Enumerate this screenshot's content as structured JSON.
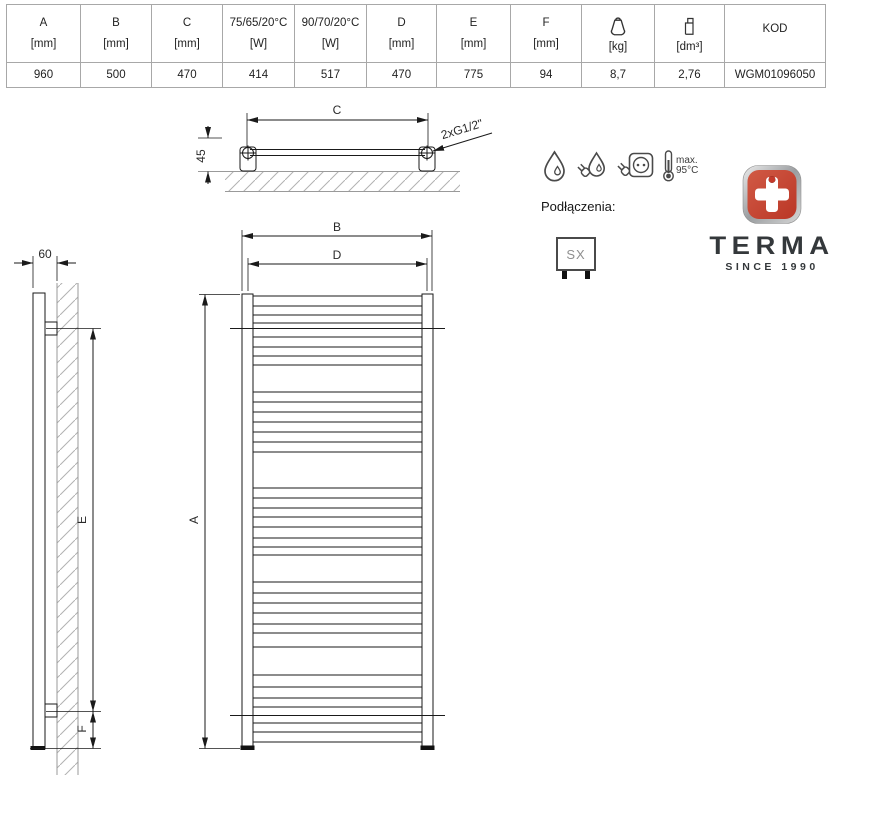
{
  "table": {
    "columns": [
      {
        "line1": "A",
        "line2": "[mm]",
        "value": "960"
      },
      {
        "line1": "B",
        "line2": "[mm]",
        "value": "500"
      },
      {
        "line1": "C",
        "line2": "[mm]",
        "value": "470"
      },
      {
        "line1": "75/65/20°C",
        "line2": "[W]",
        "value": "414"
      },
      {
        "line1": "90/70/20°C",
        "line2": "[W]",
        "value": "517"
      },
      {
        "line1": "D",
        "line2": "[mm]",
        "value": "470"
      },
      {
        "line1": "E",
        "line2": "[mm]",
        "value": "775"
      },
      {
        "line1": "F",
        "line2": "[mm]",
        "value": "94"
      },
      {
        "icon": "weight-icon",
        "line2": "[kg]",
        "value": "8,7"
      },
      {
        "icon": "volume-icon",
        "line2": "[dm³]",
        "value": "2,76"
      },
      {
        "line1": "KOD",
        "line2": "",
        "value": "WGM01096050"
      }
    ]
  },
  "diagram": {
    "labels": {
      "c": "C",
      "depth45": "45",
      "connection": "2xG1/2\"",
      "a": "A",
      "b": "B",
      "d": "D",
      "depth60": "60",
      "e": "E",
      "f": "F"
    },
    "front": {
      "rungs": [
        296,
        306,
        315,
        323,
        337,
        347,
        356,
        365,
        392,
        402,
        412,
        422,
        432,
        442,
        452,
        488,
        498,
        508,
        517,
        527,
        538,
        547,
        555,
        582,
        593,
        603,
        613,
        624,
        633,
        647,
        675,
        687,
        698,
        707,
        723,
        732,
        742
      ]
    }
  },
  "features": {
    "max_temp_line1": "max.",
    "max_temp_line2": "95°C"
  },
  "connections": {
    "heading": "Podłączenia:",
    "type": "SX"
  },
  "brand": {
    "name": "TERMA",
    "tagline": "SINCE 1990"
  }
}
